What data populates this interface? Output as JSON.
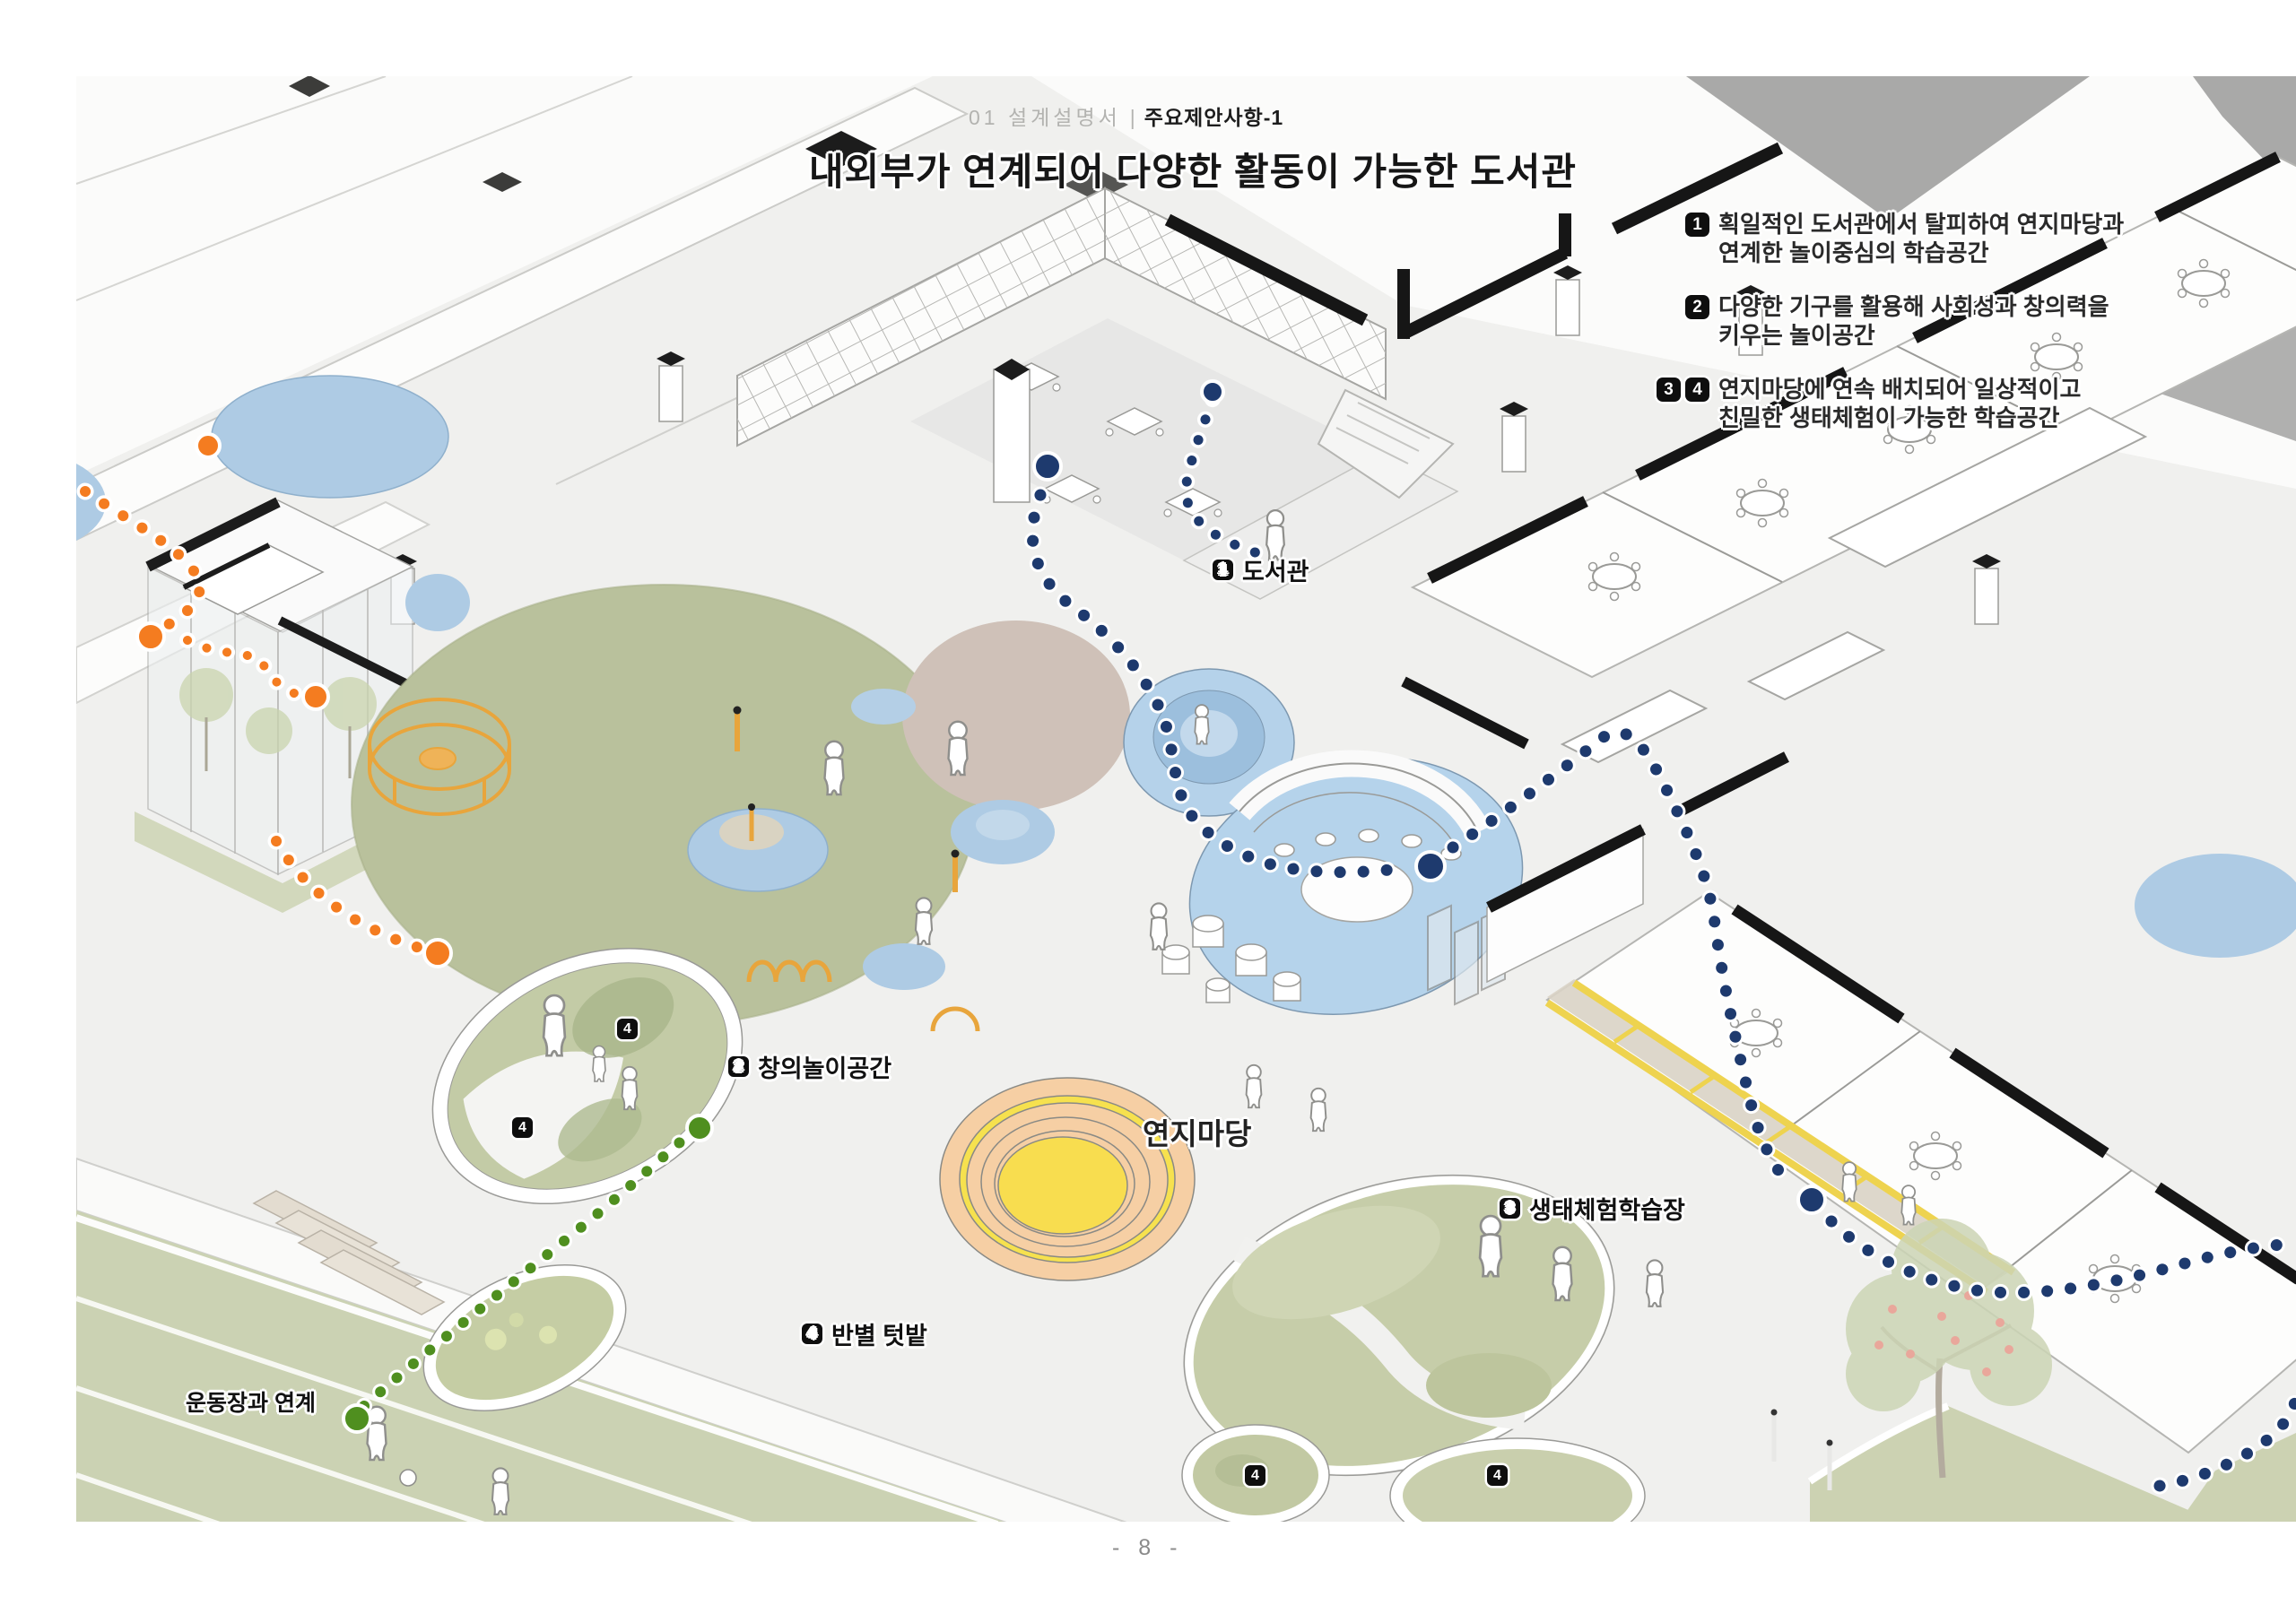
{
  "header": {
    "section": "01 설계설명서",
    "divider": "|",
    "subsection": "주요제안사항-1"
  },
  "title": "내외부가 연계되어 다양한 활동이 가능한 도서관",
  "annotations": [
    {
      "badges": [
        "1"
      ],
      "line1": "획일적인 도서관에서 탈피하여 연지마당과",
      "line2": "연계한 놀이중심의 학습공간"
    },
    {
      "badges": [
        "2"
      ],
      "line1": "다양한 기구를 활용해 사회성과 창의력을",
      "line2": "키우는 놀이공간"
    },
    {
      "badges": [
        "3",
        "4"
      ],
      "line1": "연지마당에 연속 배치되어 일상적이고",
      "line2": "친밀한 생태체험이 가능한 학습공간"
    }
  ],
  "plan_labels": {
    "library": {
      "badge": "1",
      "label": "도서관"
    },
    "creative_play": {
      "badge": "2",
      "label": "창의놀이공간"
    },
    "eco_learning": {
      "badge": "3",
      "label": "생태체험학습장"
    },
    "class_garden": {
      "badge": "4",
      "label": "반별 텃밭"
    },
    "pond_plaza": {
      "label": "연지마당"
    },
    "playground_link": {
      "label": "운동장과 연계"
    },
    "garden_plot_badge": "4"
  },
  "page_number": "- 8 -",
  "colors": {
    "path_indoor_navy": "#1e3a6e",
    "path_outdoor_orange": "#f47c20",
    "path_field_green": "#4f8f1f",
    "grass_green": "#b9c19c",
    "water_blue": "#b5d3ea",
    "pond_sand": "#f6cfa4",
    "pond_yellow": "#f7dd4e",
    "veranda_yellow": "#eed34f",
    "roof_gray": "#a9a9a8",
    "badge_black": "#0e0e0e"
  }
}
